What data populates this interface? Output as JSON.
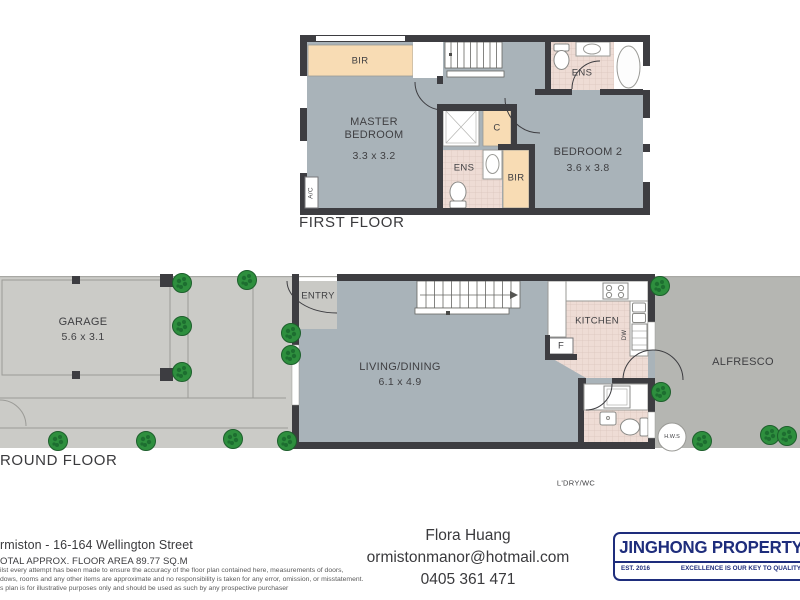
{
  "colors": {
    "wall": "#3d3d41",
    "floor": "#a9b3b9",
    "robe_peach": "#f8dcb4",
    "tile_pink": "#eedcd5",
    "concrete": "#cbcbc7",
    "alfresco_gray": "#b5b6b2",
    "bush_green": "#2e8f3e",
    "brand_navy": "#1e2d7c"
  },
  "first_floor": {
    "title": "FIRST FLOOR",
    "bir_top": "BIR",
    "bir_mid": "BIR",
    "closet": "C",
    "ens_top": "ENS",
    "ens_mid": "ENS",
    "ac": "A/C",
    "master": {
      "line1": "MASTER",
      "line2": "BEDROOM",
      "dims": "3.3 x 3.2"
    },
    "bedroom2": {
      "name": "BEDROOM 2",
      "dims": "3.6 x 3.8"
    }
  },
  "ground_floor": {
    "title": "ROUND FLOOR",
    "garage": {
      "name": "GARAGE",
      "dims": "5.6 x 3.1"
    },
    "living": {
      "name": "LIVING/DINING",
      "dims": "6.1 x 4.9"
    },
    "kitchen": "KITCHEN",
    "entry": "ENTRY",
    "alfresco": "ALFRESCO",
    "laundry": "L'DRY/WC",
    "fridge": "F",
    "dishwasher": "DW",
    "hot_water": "H.W.S"
  },
  "footer": {
    "address_line": "rmiston - 16-164 Wellington Street",
    "area_line": "OTAL APPROX. FLOOR AREA 89.77 SQ.M",
    "disclaimer1": "ilst every attempt has been made to ensure the accuracy of the floor plan contained here, measurements of doors,",
    "disclaimer2": "dows, rooms and any other items are approximate and no responsibility is taken for any error, omission, or misstatement.",
    "disclaimer3": "s plan is for illustrative purposes only and should be used as such by any prospective purchaser",
    "agent": {
      "name": "Flora Huang",
      "email": "ormistonmanor@hotmail.com",
      "phone": "0405 361 471"
    },
    "logo": {
      "brand": "JINGHONG PROPERTY",
      "established": "EST. 2016",
      "slogan": "EXCELLENCE IS OUR KEY TO QUALITY"
    }
  }
}
